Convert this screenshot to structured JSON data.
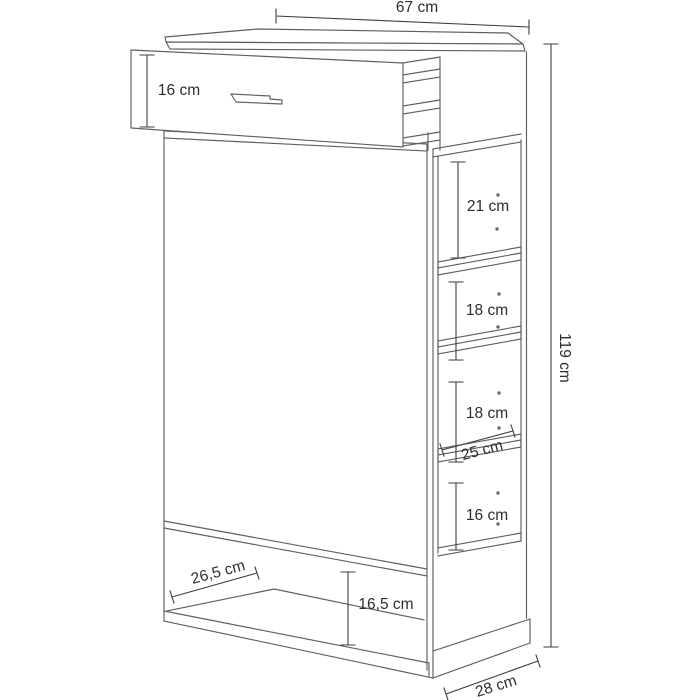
{
  "diagram": {
    "type": "furniture-dimension-diagram",
    "unit": "cm",
    "labels": {
      "width_top": "67 cm",
      "drawer_height": "16 cm",
      "compartment_1": "21 cm",
      "compartment_2": "18 cm",
      "compartment_3": "18 cm",
      "compartment_4": "16 cm",
      "side_shelf_depth": "25 cm",
      "base_inner_depth": "26,5 cm",
      "base_opening_height": "16,5 cm",
      "total_height": "119 cm",
      "depth_bottom": "28 cm"
    },
    "colors": {
      "background": "#ffffff",
      "furniture_line": "#5f5f5f",
      "dimension_line": "#3e3e3e",
      "text": "#2d2d2d"
    }
  }
}
